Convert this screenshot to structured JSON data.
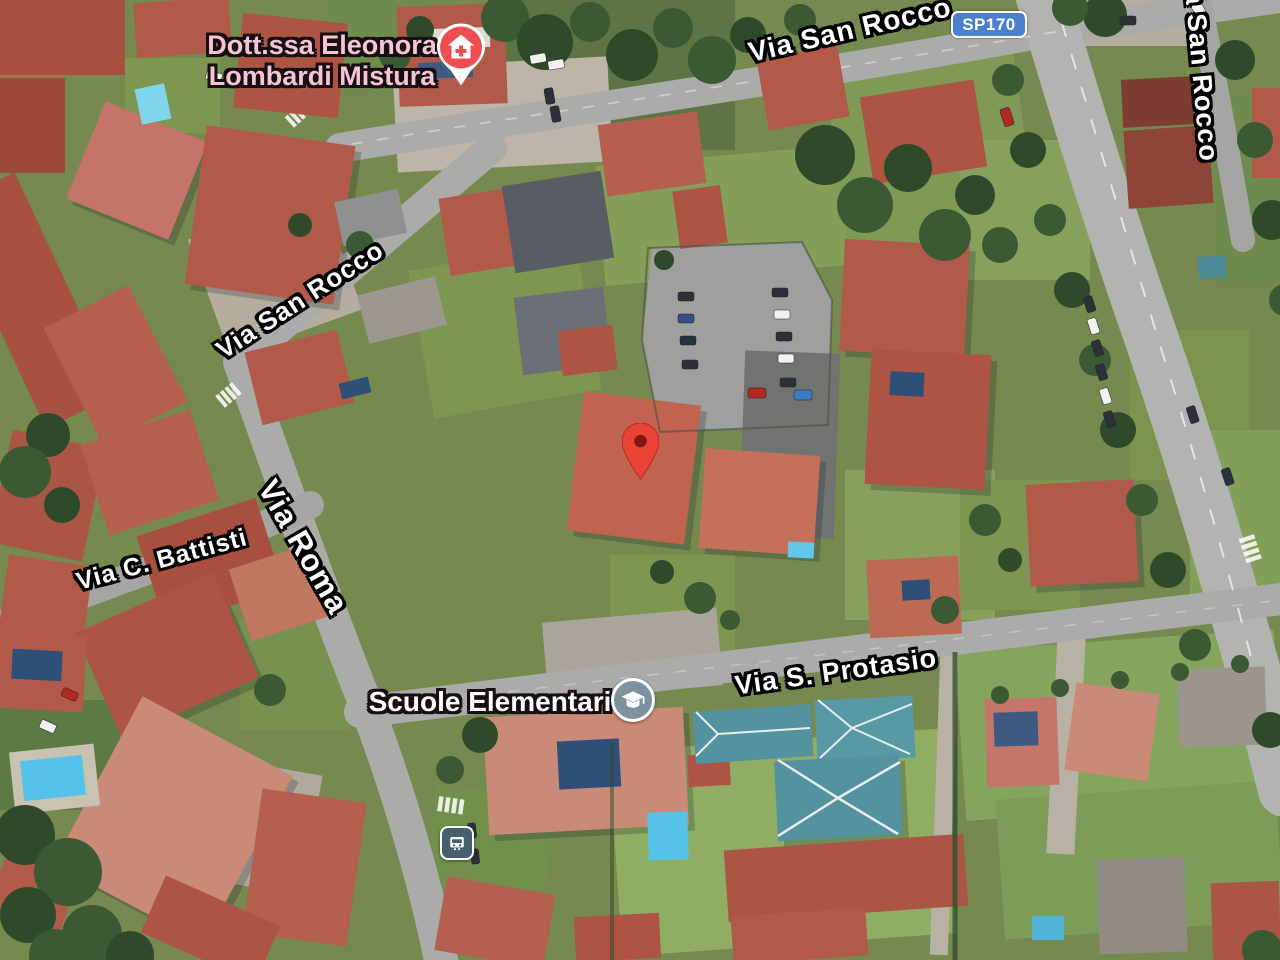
{
  "map": {
    "view_type": "satellite",
    "street_labels": {
      "san_rocco_top": "Via San Rocco",
      "san_rocco_left": "Via San Rocco",
      "san_rocco_right": "Via San Rocco",
      "battisti": "Via C. Battisti",
      "roma": "Via Roma",
      "protasio": "Via S. Protasio"
    },
    "route_badge": {
      "label": "SP170",
      "bg_color": "#4b80cf",
      "border_color": "#ffffff",
      "text_color": "#ffffff"
    },
    "pois": {
      "doctor": {
        "line1": "Dott.ssa Eleonora",
        "line2": "Lombardi Mistura",
        "category": "health",
        "icon": "health-pin-icon",
        "label_color": "#f6c4d2",
        "icon_color": "#ee4d52"
      },
      "school": {
        "label": "Scuole Elementari",
        "category": "school",
        "icon": "school-icon",
        "label_color": "#ffffff",
        "icon_color": "#7e929e"
      },
      "bus_stop": {
        "category": "transit",
        "icon": "bus-icon",
        "icon_color": "#46606d"
      }
    },
    "marker": {
      "type": "destination-pin",
      "color": "#ea4335",
      "dot_color": "#7c1a10"
    },
    "terrain_palette": {
      "road": "#ababa9",
      "highway": "#b3b3b1",
      "roof_red": "#b25a49",
      "roof_salmon": "#c98a77",
      "roof_dark": "#585d64",
      "roof_teal": "#53929e",
      "grass": "#7d9751",
      "tree": "#3b5a34",
      "pool": "#55c3e8",
      "paved": "#b5ae9f"
    }
  }
}
